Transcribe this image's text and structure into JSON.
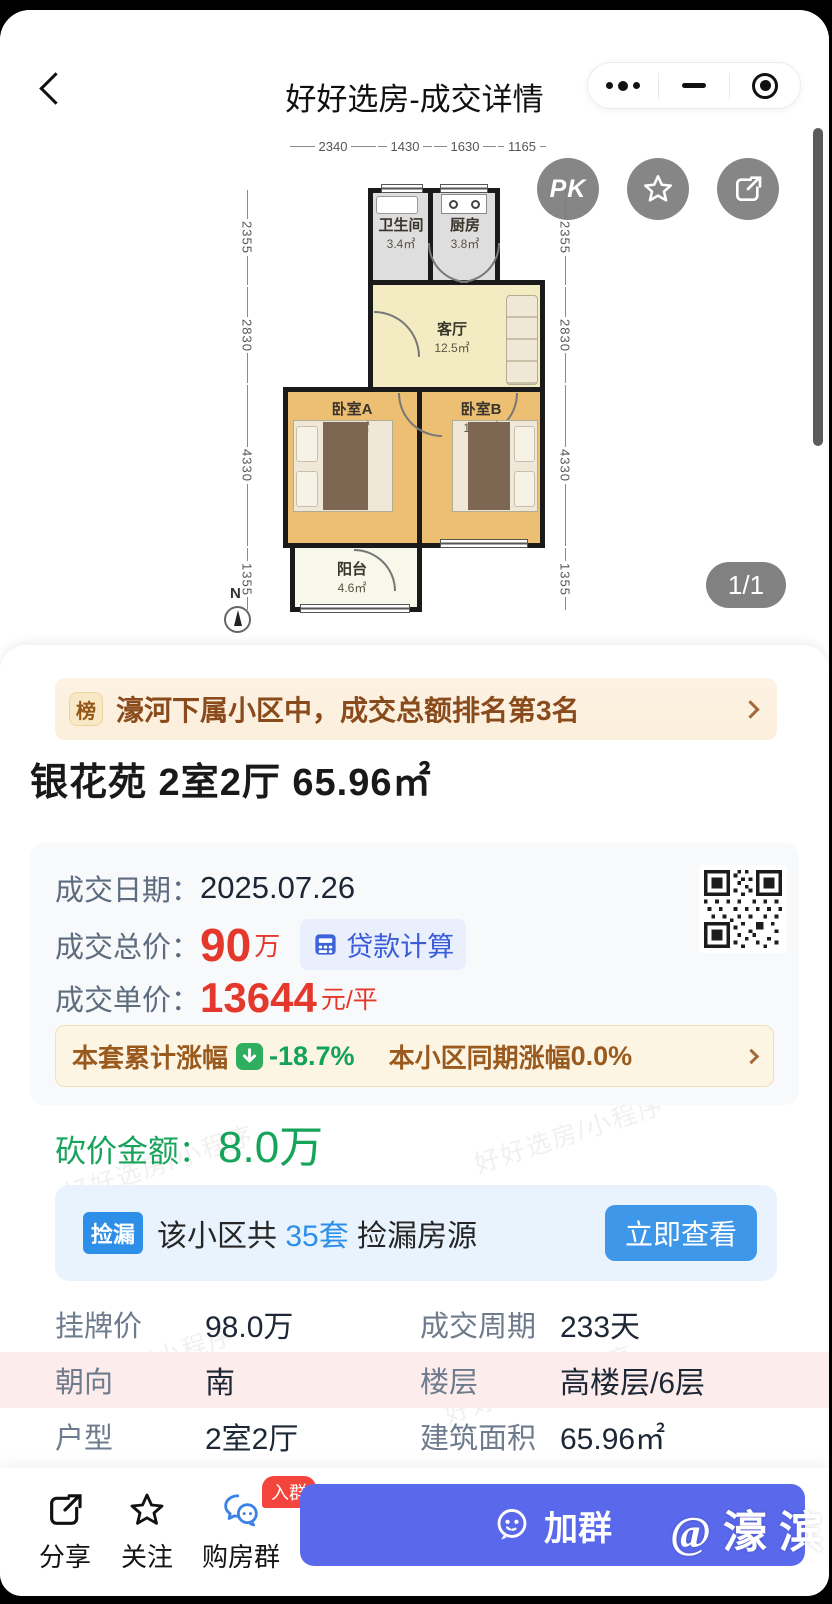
{
  "header": {
    "title": "好好选房-成交详情"
  },
  "floorplan": {
    "dims_top": [
      "2340",
      "1430",
      "1630",
      "1165"
    ],
    "dims_left": [
      "2355",
      "2830",
      "4330",
      "1355"
    ],
    "dims_right": [
      "2355",
      "2830",
      "4330",
      "1355"
    ],
    "rooms": {
      "bathroom": {
        "name": "卫生间",
        "area": "3.4㎡"
      },
      "kitchen": {
        "name": "厨房",
        "area": "3.8㎡"
      },
      "living": {
        "name": "客厅",
        "area": "12.5㎡"
      },
      "bedroomA": {
        "name": "卧室A",
        "area": "14.9㎡"
      },
      "bedroomB": {
        "name": "卧室B",
        "area": "14.1㎡"
      },
      "balcony": {
        "name": "阳台",
        "area": "4.6㎡"
      }
    },
    "north": "N",
    "pk": "PK",
    "page_indicator": "1/1"
  },
  "rank_banner": {
    "badge": "榜",
    "text": "濠河下属小区中，成交总额排名第3名"
  },
  "listing_title": "银花苑 2室2厅 65.96㎡",
  "deal_info": {
    "date_label": "成交日期：",
    "date": "2025.07.26",
    "total_label": "成交总价：",
    "total": "90",
    "total_unit": "万",
    "loan_calc": "贷款计算",
    "unit_label": "成交单价：",
    "unit_price": "13644",
    "unit_suffix": "元/平"
  },
  "change_banner": {
    "label": "本套累计涨幅",
    "value": "-18.7%",
    "peer_label": "本小区同期涨幅",
    "peer_value": "0.0%"
  },
  "bargain": {
    "label": "砍价金额：",
    "value": "8.0万"
  },
  "deal_banner": {
    "badge": "捡漏",
    "prefix": "该小区共 ",
    "count": "35套",
    "suffix": " 捡漏房源",
    "button": "立即查看"
  },
  "details": {
    "rows": [
      [
        {
          "label": "挂牌价",
          "value": "98.0万"
        },
        {
          "label": "成交周期",
          "value": "233天"
        }
      ],
      [
        {
          "label": "朝向",
          "value": "南"
        },
        {
          "label": "楼层",
          "value": "高楼层/6层"
        }
      ],
      [
        {
          "label": "户型",
          "value": "2室2厅"
        },
        {
          "label": "建筑面积",
          "value": "65.96㎡"
        }
      ]
    ]
  },
  "footer": {
    "share": "分享",
    "follow": "关注",
    "group": "购房群",
    "group_badge": "入群",
    "join": "加群",
    "mention": "@濠滨"
  },
  "watermark": {
    "text": "好好选房/小程序"
  },
  "colors": {
    "accent_red": "#e5382c",
    "accent_blue": "#2e8fe8",
    "accent_green": "#16a35a",
    "banner_brown": "#8a4b1c",
    "join_purple": "#5a68ec"
  },
  "icons": {
    "back": "chevron-left",
    "capsule_more": "ellipsis",
    "capsule_minimize": "minus",
    "capsule_record": "target",
    "favorite": "star",
    "share": "external-share",
    "loan": "calculator",
    "trend": "arrow-down",
    "group": "chat-bubbles",
    "join": "smiley-bubble"
  }
}
